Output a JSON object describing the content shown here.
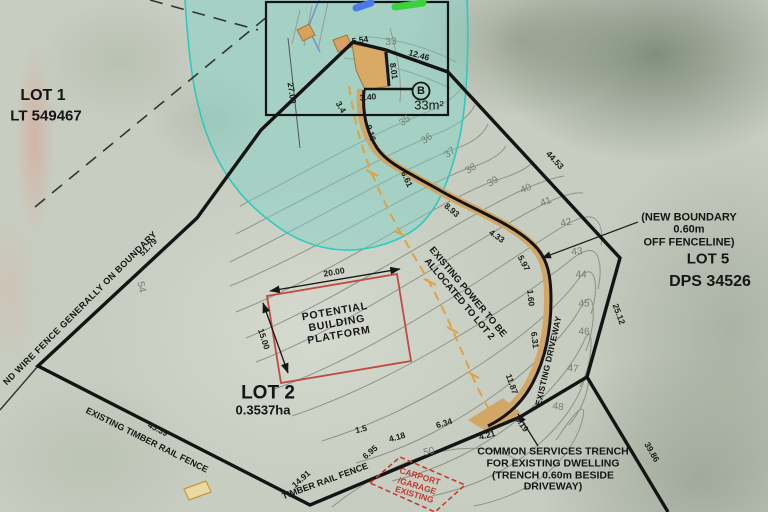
{
  "lots": {
    "lot1": {
      "name": "LOT 1",
      "title": "LT 549467"
    },
    "lot2": {
      "name": "LOT 2",
      "area": "0.3537ha"
    },
    "lot5": {
      "name": "LOT 5",
      "title": "DPS 34526"
    }
  },
  "area_b": {
    "label": "B",
    "area": "33m²"
  },
  "annotations": {
    "new_boundary": [
      "(NEW BOUNDARY",
      "0.60m",
      "OFF FENCELINE)"
    ],
    "common_services": [
      "COMMON SERVICES TRENCH",
      "FOR EXISTING DWELLING",
      "(TRENCH 0.60m BESIDE",
      "DRIVEWAY)"
    ],
    "building_platform": [
      "POTENTIAL",
      "BUILDING",
      "PLATFORM"
    ],
    "carport": [
      "CARPORT",
      "/GARAGE",
      "EXISTING"
    ],
    "existing_power": [
      "EXISTING POWER TO BE",
      "ALLOCATED TO LOT 2"
    ],
    "existing_driveway": "EXISTING DRIVEWAY",
    "fence_upper": "EXISTING TIMBER RAIL FENCE",
    "fence_lower": "TIMBER RAIL FENCE",
    "wire_fence": "ND WIRE FENCE GENERALLY ON BOUNDARY"
  },
  "measurements": [
    {
      "t": "5.54",
      "x": 360,
      "y": 40,
      "r": -8
    },
    {
      "t": "12.46",
      "x": 419,
      "y": 55,
      "r": 16
    },
    {
      "t": "8.01",
      "x": 394,
      "y": 71,
      "r": 82
    },
    {
      "t": "27.00",
      "x": 292,
      "y": 93,
      "r": 82
    },
    {
      "t": "3.40",
      "x": 368,
      "y": 97,
      "r": -5
    },
    {
      "t": "3.4",
      "x": 341,
      "y": 107,
      "r": 60
    },
    {
      "t": "9.16",
      "x": 371,
      "y": 133,
      "r": 72
    },
    {
      "t": "6.61",
      "x": 407,
      "y": 179,
      "r": 65
    },
    {
      "t": "8.93",
      "x": 452,
      "y": 210,
      "r": 40
    },
    {
      "t": "4.33",
      "x": 497,
      "y": 236,
      "r": 35
    },
    {
      "t": "5.97",
      "x": 524,
      "y": 263,
      "r": 62
    },
    {
      "t": "1.60",
      "x": 531,
      "y": 298,
      "r": 85
    },
    {
      "t": "6.31",
      "x": 535,
      "y": 340,
      "r": 83
    },
    {
      "t": "11.87",
      "x": 512,
      "y": 384,
      "r": 70
    },
    {
      "t": "3.19",
      "x": 522,
      "y": 424,
      "r": 55
    },
    {
      "t": "4.21",
      "x": 487,
      "y": 435,
      "r": -14
    },
    {
      "t": "6.34",
      "x": 444,
      "y": 423,
      "r": -17
    },
    {
      "t": "4.18",
      "x": 397,
      "y": 437,
      "r": -16
    },
    {
      "t": "1.5",
      "x": 361,
      "y": 429,
      "r": -14
    },
    {
      "t": "6.95",
      "x": 370,
      "y": 452,
      "r": -40
    },
    {
      "t": "45.39",
      "x": 158,
      "y": 429,
      "r": 27
    },
    {
      "t": "14.91",
      "x": 301,
      "y": 479,
      "r": -42
    },
    {
      "t": "51.79",
      "x": 148,
      "y": 247,
      "r": -45
    },
    {
      "t": "44.53",
      "x": 555,
      "y": 160,
      "r": 47
    },
    {
      "t": "25.12",
      "x": 619,
      "y": 314,
      "r": 70
    },
    {
      "t": "39.86",
      "x": 652,
      "y": 452,
      "r": 60
    },
    {
      "t": "20.00",
      "x": 334,
      "y": 272,
      "r": -10
    },
    {
      "t": "15.00",
      "x": 264,
      "y": 339,
      "r": 72
    }
  ],
  "contour_labels": [
    {
      "t": "33",
      "x": 391,
      "y": 42,
      "r": -5
    },
    {
      "t": "35",
      "x": 405,
      "y": 121,
      "r": -35
    },
    {
      "t": "36",
      "x": 427,
      "y": 139,
      "r": -35
    },
    {
      "t": "37",
      "x": 450,
      "y": 153,
      "r": -35
    },
    {
      "t": "38",
      "x": 471,
      "y": 169,
      "r": -33
    },
    {
      "t": "39",
      "x": 493,
      "y": 182,
      "r": -30
    },
    {
      "t": "40",
      "x": 526,
      "y": 189,
      "r": -22
    },
    {
      "t": "41",
      "x": 546,
      "y": 202,
      "r": -22
    },
    {
      "t": "42",
      "x": 566,
      "y": 223,
      "r": -12
    },
    {
      "t": "43",
      "x": 577,
      "y": 252,
      "r": -5
    },
    {
      "t": "44",
      "x": 581,
      "y": 275,
      "r": 0
    },
    {
      "t": "45",
      "x": 584,
      "y": 304,
      "r": 0
    },
    {
      "t": "46",
      "x": 584,
      "y": 332,
      "r": 3
    },
    {
      "t": "47",
      "x": 573,
      "y": 369,
      "r": 6
    },
    {
      "t": "48",
      "x": 558,
      "y": 407,
      "r": 8
    },
    {
      "t": "50",
      "x": 429,
      "y": 452,
      "r": -12
    },
    {
      "t": "54",
      "x": 141,
      "y": 287,
      "r": 78
    }
  ],
  "colors": {
    "overlay_teal": "#45cfc4",
    "driveway_tan": "#d2a765",
    "platform_red": "#bf4a40",
    "power_orange": "#dfa243",
    "contour_gray": "#878d82",
    "boundary_black": "#141414",
    "marker_blue": "#4a79e8",
    "marker_green": "#3ad23a"
  }
}
